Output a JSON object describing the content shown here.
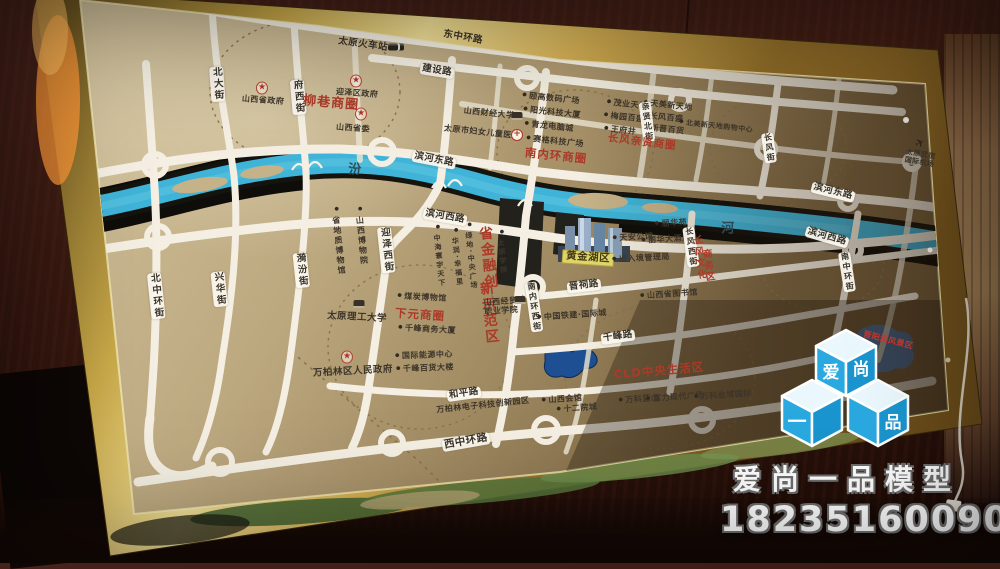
{
  "watermark": {
    "cubes": [
      "爱",
      "尚",
      "一",
      "品"
    ],
    "company": "爱尚一品模型",
    "phone": "18235160090"
  },
  "colors": {
    "logo_blue": "#29a8e0",
    "frame_gold": "#d8b858",
    "river_blue": "#45b6d9",
    "map_bronze": "#b5a27a",
    "label_red": "#ac3a28",
    "highlight_yellow": "#ddd46a"
  },
  "map": {
    "labels": [
      {
        "id": "taiyuan-railway-station",
        "t": "太原火车站",
        "x": 363,
        "y": 45,
        "c": "dk s9",
        "r": 8
      },
      {
        "id": "donghuan-east-road",
        "t": "东中环路",
        "x": 463,
        "y": 38,
        "c": "dk s9",
        "r": 10
      },
      {
        "id": "jianshe-road",
        "t": "建设路",
        "x": 437,
        "y": 71,
        "c": "plate s9",
        "r": 9
      },
      {
        "id": "beida-street",
        "t": "北大街",
        "x": 217,
        "y": 84,
        "c": "plate v s9",
        "r": -4
      },
      {
        "id": "fuxi-street",
        "t": "府西街",
        "x": 298,
        "y": 97,
        "c": "plate v s9",
        "r": -5
      },
      {
        "id": "shanxi-prov-gov",
        "t": "山西省政府",
        "x": 263,
        "y": 101,
        "c": "dk s8",
        "r": 4
      },
      {
        "id": "yingze-district-gov",
        "t": "迎泽区政府",
        "x": 357,
        "y": 94,
        "c": "dk s8",
        "r": 4
      },
      {
        "id": "liuxiang-circle",
        "t": "柳巷商圈",
        "x": 331,
        "y": 104,
        "c": "red s12",
        "r": 5
      },
      {
        "id": "shanxi-committee",
        "t": "山西省委",
        "x": 353,
        "y": 129,
        "c": "dk s8",
        "r": 4
      },
      {
        "id": "shanxi-caida",
        "t": "山西财经大学",
        "x": 489,
        "y": 114,
        "c": "dk s8",
        "r": 6
      },
      {
        "id": "fuyou-hospital",
        "t": "太原市妇女儿童医院",
        "x": 482,
        "y": 133,
        "c": "dk s8",
        "r": 6
      },
      {
        "id": "yigao-plaza",
        "t": "颐高数码广场",
        "x": 551,
        "y": 99,
        "c": "dk s8 dot",
        "r": 6
      },
      {
        "id": "yangguang-tower",
        "t": "阳光科技大厦",
        "x": 552,
        "y": 113,
        "c": "dk s8 dot",
        "r": 6
      },
      {
        "id": "qinglong-mall",
        "t": "青龙电脑城",
        "x": 549,
        "y": 127,
        "c": "dk s8 dot",
        "r": 6
      },
      {
        "id": "saige-plaza",
        "t": "赛格科技广场",
        "x": 555,
        "y": 142,
        "c": "dk s8 dot",
        "r": 6
      },
      {
        "id": "nanneihuan-circle",
        "t": "南内环商圈",
        "x": 556,
        "y": 156,
        "c": "red s11",
        "r": 6
      },
      {
        "id": "maoye-tiandi",
        "t": "茂业天地",
        "x": 627,
        "y": 105,
        "c": "dk s8 dot",
        "r": 6
      },
      {
        "id": "meiyuan-parkson",
        "t": "梅园百盛",
        "x": 624,
        "y": 118,
        "c": "dk s8 dot",
        "r": 6
      },
      {
        "id": "wangfujing",
        "t": "王府井",
        "x": 620,
        "y": 131,
        "c": "dk s8 dot",
        "r": 6
      },
      {
        "id": "tianmei-xintiandi",
        "t": "天美新天地",
        "x": 668,
        "y": 106,
        "c": "dk s8 dot",
        "r": 6
      },
      {
        "id": "changfeng-parkson",
        "t": "长风百盛",
        "x": 663,
        "y": 118,
        "c": "dk s8 dot",
        "r": 6
      },
      {
        "id": "xinjin-dept",
        "t": "新晋百货",
        "x": 664,
        "y": 130,
        "c": "dk s8 dot",
        "r": 6
      },
      {
        "id": "beimei-mall",
        "t": "北美新天地购物中心",
        "x": 716,
        "y": 127,
        "c": "dk s7 dot",
        "r": 6
      },
      {
        "id": "qinxian-north-street",
        "t": "亲贤北街",
        "x": 647,
        "y": 122,
        "c": "plate v s8",
        "r": -7
      },
      {
        "id": "changfeng-qinxian-circle",
        "t": "长风亲贤商圈",
        "x": 642,
        "y": 143,
        "c": "red s10",
        "r": 7
      },
      {
        "id": "changfeng-street",
        "t": "长风街",
        "x": 769,
        "y": 148,
        "c": "plate v s8",
        "r": -8
      },
      {
        "id": "binhe-east-a",
        "t": "滨河东路",
        "x": 434,
        "y": 160,
        "c": "plate s9",
        "r": 11
      },
      {
        "id": "binhe-east-b",
        "t": "滨河东路",
        "x": 833,
        "y": 192,
        "c": "plate s9",
        "r": 14
      },
      {
        "id": "fen-char",
        "t": "汾",
        "x": 355,
        "y": 171,
        "c": "riv s12",
        "r": 0
      },
      {
        "id": "he-char",
        "t": "河",
        "x": 728,
        "y": 230,
        "c": "riv s12",
        "r": 0
      },
      {
        "id": "binhe-west-a",
        "t": "滨河西路",
        "x": 445,
        "y": 217,
        "c": "plate s9",
        "r": 10
      },
      {
        "id": "binhe-west-b",
        "t": "滨河西路",
        "x": 827,
        "y": 237,
        "c": "plate s9",
        "r": 16
      },
      {
        "id": "dizhi-museum",
        "t": "省地质博物馆",
        "x": 338,
        "y": 241,
        "c": "dk v s8 dot",
        "r": -6
      },
      {
        "id": "shanxi-museum",
        "t": "山西博物院",
        "x": 361,
        "y": 236,
        "c": "dk v s8 dot",
        "r": -6
      },
      {
        "id": "yifen-street",
        "t": "漪汾街",
        "x": 301,
        "y": 270,
        "c": "plate v s9",
        "r": -6
      },
      {
        "id": "xinghua-street",
        "t": "兴华街",
        "x": 219,
        "y": 289,
        "c": "plate v s9",
        "r": -6
      },
      {
        "id": "beizhonghuan-street",
        "t": "北中环街",
        "x": 156,
        "y": 296,
        "c": "plate v s9",
        "r": -6
      },
      {
        "id": "yingze-west-street",
        "t": "迎泽西街",
        "x": 386,
        "y": 250,
        "c": "plate v s9",
        "r": -6
      },
      {
        "id": "ligong-university",
        "t": "太原理工大学",
        "x": 357,
        "y": 318,
        "c": "dk s9",
        "r": 3
      },
      {
        "id": "meitan-museum",
        "t": "煤炭博物馆",
        "x": 422,
        "y": 298,
        "c": "dk s8 dot",
        "r": 3
      },
      {
        "id": "xiayuan-circle",
        "t": "下元商圈",
        "x": 420,
        "y": 315,
        "c": "red s11",
        "r": 4
      },
      {
        "id": "qianfeng-biz-tower",
        "t": "千峰商务大厦",
        "x": 427,
        "y": 330,
        "c": "dk s8 dot",
        "r": 3
      },
      {
        "id": "wanbolin-gov",
        "t": "万柏林区人民政府",
        "x": 353,
        "y": 372,
        "c": "dk s9",
        "r": -3
      },
      {
        "id": "intl-energy-center",
        "t": "国际能源中心",
        "x": 424,
        "y": 356,
        "c": "dk s8 dot",
        "r": -2
      },
      {
        "id": "qianfeng-dept-store",
        "t": "千峰百货大楼",
        "x": 425,
        "y": 369,
        "c": "dk s8 dot",
        "r": -2
      },
      {
        "id": "heping-road",
        "t": "和平路",
        "x": 464,
        "y": 394,
        "c": "plate s9",
        "r": -8
      },
      {
        "id": "wbl-tech-park",
        "t": "万柏林电子科技创新园区",
        "x": 483,
        "y": 406,
        "c": "dk s8",
        "r": -6
      },
      {
        "id": "xizhonghuan-road",
        "t": "西中环路",
        "x": 466,
        "y": 442,
        "c": "plate s10",
        "r": -10
      },
      {
        "id": "nanneihuan-west-street",
        "t": "南内环西街",
        "x": 534,
        "y": 307,
        "c": "plate v s8",
        "r": -8
      },
      {
        "id": "prov-finance-zone-1",
        "t": "省金融创",
        "x": 487,
        "y": 258,
        "c": "redv s13",
        "r": -6
      },
      {
        "id": "prov-finance-zone-2",
        "t": "新示范区",
        "x": 488,
        "y": 313,
        "c": "redv s13",
        "r": -6
      },
      {
        "id": "zhonghai-huanyu",
        "t": "中海寰宇天下",
        "x": 439,
        "y": 256,
        "c": "dk v s7 dot",
        "r": -6
      },
      {
        "id": "huarun-xingfuli",
        "t": "华润·幸福里",
        "x": 457,
        "y": 257,
        "c": "dk v s7 dot",
        "r": -6
      },
      {
        "id": "lvdi-central-plaza",
        "t": "绿地·中央广场",
        "x": 471,
        "y": 256,
        "c": "dk v s7 dot",
        "r": -6
      },
      {
        "id": "taiyuan-college",
        "t": "太原学院",
        "x": 502,
        "y": 252,
        "c": "dk v s7 dot",
        "r": -6
      },
      {
        "id": "jingmao-college",
        "t": "山西经贸\n职业学院",
        "x": 501,
        "y": 307,
        "c": "dk s8",
        "r": -4
      },
      {
        "id": "project-name",
        "t": "黄金湖区",
        "x": 588,
        "y": 258,
        "c": "hl s10",
        "r": 4
      },
      {
        "id": "jinci-road",
        "t": "晋祠路",
        "x": 584,
        "y": 286,
        "c": "plate s9",
        "r": -7
      },
      {
        "id": "tianan-mansion",
        "t": "天安公馆",
        "x": 633,
        "y": 238,
        "c": "dk s8 dot",
        "r": -3
      },
      {
        "id": "exit-entry-admin",
        "t": "出入境管理局",
        "x": 641,
        "y": 259,
        "c": "dk s8 dot",
        "r": -3
      },
      {
        "id": "lihua-yuan",
        "t": "丽华苑",
        "x": 671,
        "y": 224,
        "c": "dk s8 dot",
        "r": -3
      },
      {
        "id": "lihua-hotel",
        "t": "丽华大酒店",
        "x": 666,
        "y": 240,
        "c": "dk s8 dot",
        "r": -3
      },
      {
        "id": "changfeng-west-street",
        "t": "长风西街",
        "x": 691,
        "y": 247,
        "c": "plate v s8",
        "r": -8
      },
      {
        "id": "cf-culture-zone-1",
        "t": "长风文化",
        "x": 698,
        "y": 258,
        "c": "redv s9",
        "r": -7
      },
      {
        "id": "cf-culture-zone-2",
        "t": "商务区",
        "x": 707,
        "y": 266,
        "c": "redv s9",
        "r": -7
      },
      {
        "id": "shanxi-library",
        "t": "山西省图书馆",
        "x": 669,
        "y": 295,
        "c": "dk s8 dot",
        "r": -4
      },
      {
        "id": "tiejian-intl-city",
        "t": "中国铁建·国际城",
        "x": 572,
        "y": 316,
        "c": "dk s8 dot",
        "r": -4
      },
      {
        "id": "qianfeng-road",
        "t": "千峰路",
        "x": 618,
        "y": 337,
        "c": "plate s9",
        "r": -8
      },
      {
        "id": "cld-living-area",
        "t": "CLD中央生活区",
        "x": 659,
        "y": 371,
        "c": "red s11",
        "r": -5
      },
      {
        "id": "shanxi-huiguan",
        "t": "山西会馆",
        "x": 562,
        "y": 400,
        "c": "dk s8 dot",
        "r": -4
      },
      {
        "id": "twelve-courtyards",
        "t": "十二院城",
        "x": 577,
        "y": 409,
        "c": "dk s8 dot",
        "r": -4
      },
      {
        "id": "wanke-lanshan",
        "t": "万科蓝山",
        "x": 639,
        "y": 400,
        "c": "dk s8 dot",
        "r": -4
      },
      {
        "id": "fuli-modern-plaza",
        "t": "富力现代广场",
        "x": 675,
        "y": 398,
        "c": "dk s8 dot",
        "r": -4
      },
      {
        "id": "wanke-jinyu-intl",
        "t": "万科金域国际",
        "x": 723,
        "y": 396,
        "c": "dk s8 dot",
        "r": -4
      },
      {
        "id": "jinyang-lake",
        "t": "晋阳湖风景区",
        "x": 888,
        "y": 341,
        "c": "redlake s8",
        "r": 14
      },
      {
        "id": "wusu-airport",
        "t": "太原武宿\n国际机场",
        "x": 920,
        "y": 159,
        "c": "dk s7",
        "r": 10
      },
      {
        "id": "nanzhonghuan-street",
        "t": "南中环街",
        "x": 847,
        "y": 272,
        "c": "plate v s8",
        "r": -9
      }
    ],
    "markers": [
      {
        "i": "star",
        "x": 262,
        "y": 88
      },
      {
        "i": "star",
        "x": 356,
        "y": 81
      },
      {
        "i": "star",
        "x": 361,
        "y": 114
      },
      {
        "i": "star",
        "x": 347,
        "y": 357
      },
      {
        "i": "building",
        "x": 517,
        "y": 116
      },
      {
        "i": "building",
        "x": 359,
        "y": 304
      },
      {
        "i": "building",
        "x": 520,
        "y": 300
      },
      {
        "i": "cross",
        "x": 517,
        "y": 135
      },
      {
        "i": "train",
        "x": 396,
        "y": 47
      },
      {
        "i": "plane",
        "x": 920,
        "y": 143
      }
    ]
  }
}
